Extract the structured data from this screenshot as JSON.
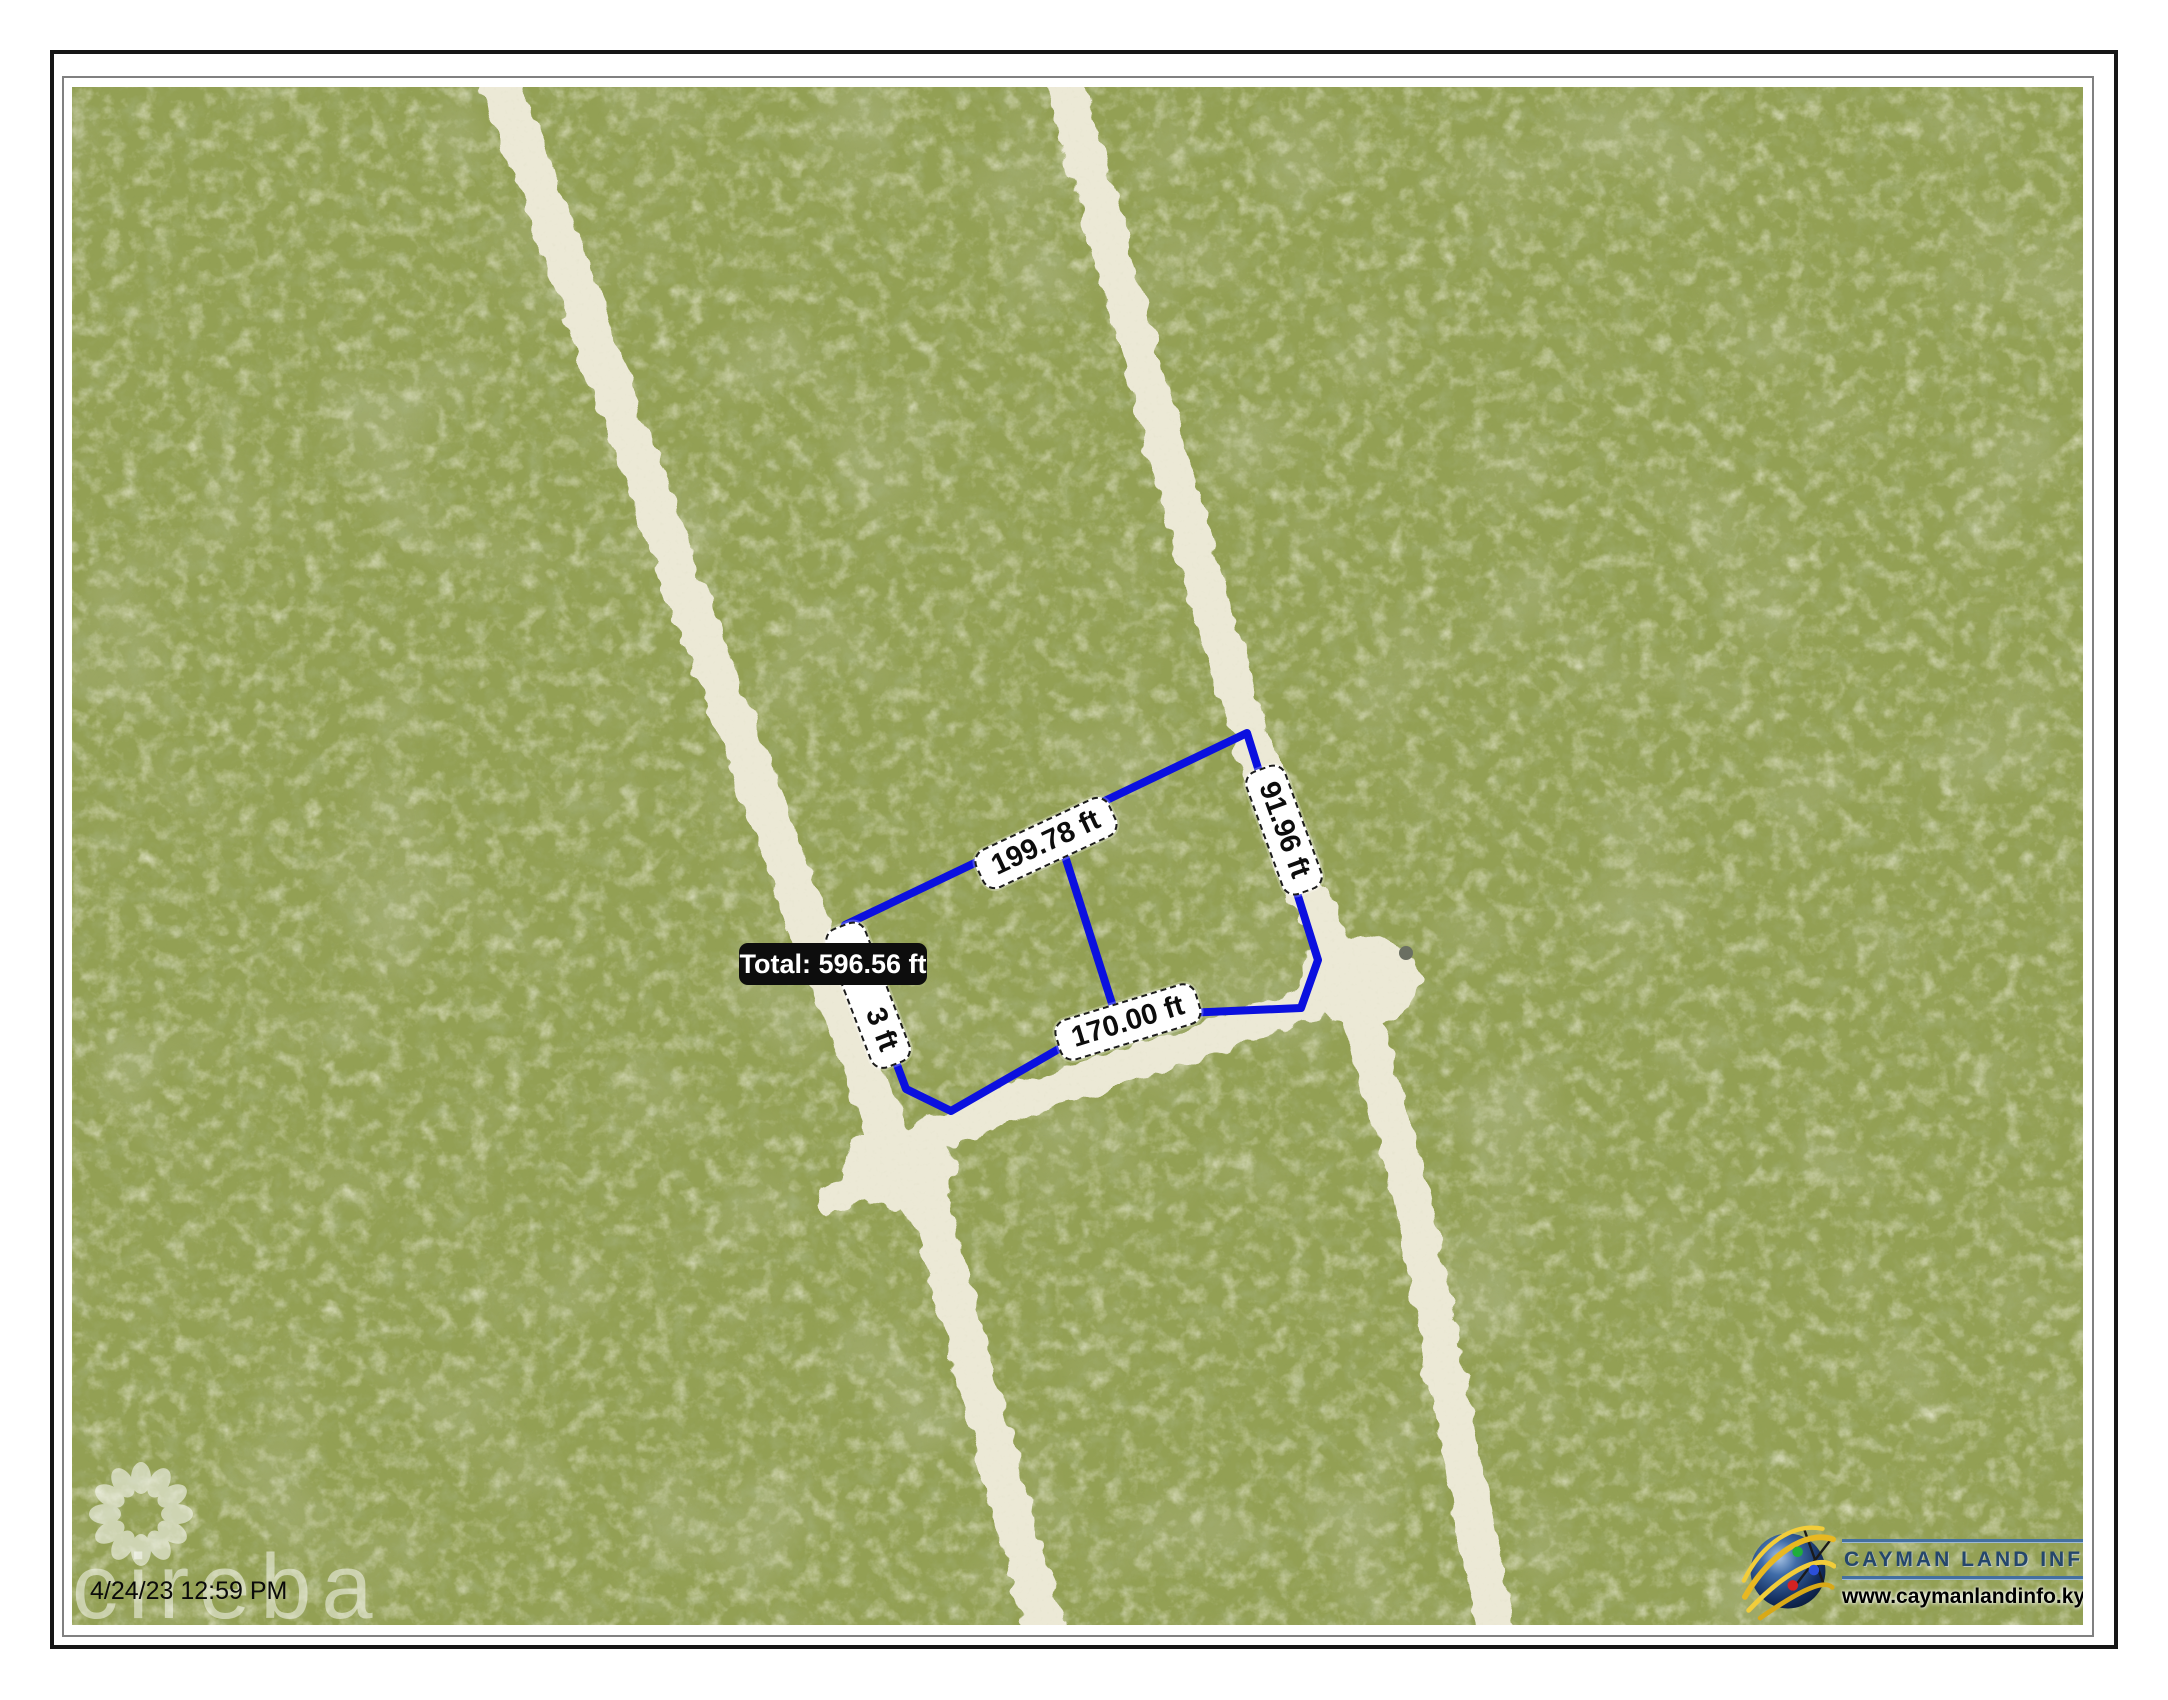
{
  "map": {
    "parcel": {
      "total_label": "Total: 596.56 ft",
      "labels": {
        "top": "199.78 ft",
        "right": "91.96 ft",
        "bottom": "170.00 ft",
        "left_visible": "3 ft"
      },
      "outline_color": "#0b10df"
    },
    "timestamp": "4/24/23 12:59 PM",
    "watermark": {
      "text": "cireba"
    },
    "terrain": {
      "vegetation_color": "#93a054",
      "road_color": "#ece9d6"
    }
  },
  "branding": {
    "logo_title": "CAYMAN LAND INFO",
    "logo_url_text": "www.caymanlandinfo.ky",
    "title_color": "#24466b",
    "globe_icon": "globe-with-orbits-icon"
  }
}
